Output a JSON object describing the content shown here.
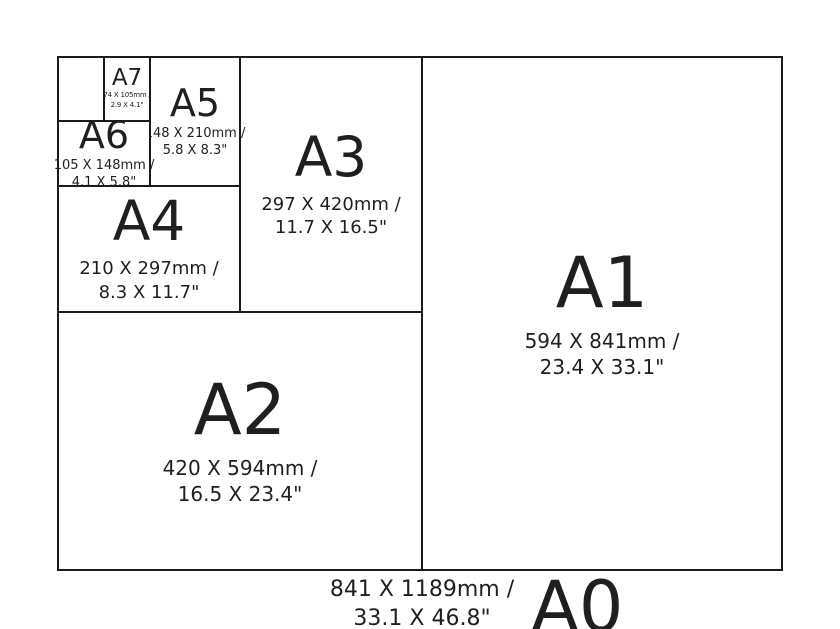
{
  "colors": {
    "background": "#ffffff",
    "line": "#1a1a1a",
    "text": "#1f1f1f"
  },
  "sizes": {
    "a0": {
      "label": "A0",
      "mm": "841 X 1189mm /",
      "inches": "33.1 X 46.8\""
    },
    "a1": {
      "label": "A1",
      "mm": "594 X 841mm /",
      "inches": "23.4 X 33.1\""
    },
    "a2": {
      "label": "A2",
      "mm": "420 X 594mm /",
      "inches": "16.5 X 23.4\""
    },
    "a3": {
      "label": "A3",
      "mm": "297 X 420mm /",
      "inches": "11.7 X 16.5\""
    },
    "a4": {
      "label": "A4",
      "mm": "210 X 297mm /",
      "inches": "8.3 X 11.7\""
    },
    "a5": {
      "label": "A5",
      "mm": "148 X 210mm /",
      "inches": "5.8 X 8.3\""
    },
    "a6": {
      "label": "A6",
      "mm": "105 X 148mm /",
      "inches": "4.1 X 5.8\""
    },
    "a7": {
      "label": "A7",
      "mm": "74 X 105mm /",
      "inches": "2.9 X 4.1\""
    }
  }
}
